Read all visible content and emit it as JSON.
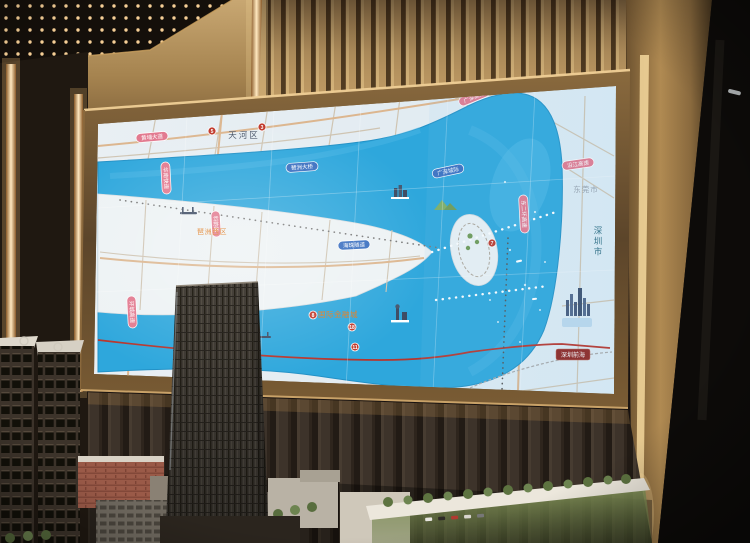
{
  "photo": {
    "screen_map": {
      "district_labels": [
        {
          "id": "tianhe",
          "text": "天河区"
        },
        {
          "id": "pazhou-west",
          "text": "琶洲西区"
        },
        {
          "id": "financial-city",
          "text": "国际金融城"
        },
        {
          "id": "dongguan",
          "text": "东莞市"
        },
        {
          "id": "shenzhen",
          "text": "深圳市"
        },
        {
          "id": "qianhai",
          "text": "深圳前海"
        }
      ],
      "road_labels": [
        {
          "text": "黄埔大道"
        },
        {
          "text": "华南快速"
        },
        {
          "text": "科韵路"
        },
        {
          "text": "广深高速"
        },
        {
          "text": "东二环高速"
        },
        {
          "text": "环城高速"
        },
        {
          "text": "沿江高速"
        }
      ],
      "rail_labels": [
        {
          "text": "琶洲大桥"
        },
        {
          "text": "广深城际"
        },
        {
          "text": "海珠隧道"
        }
      ],
      "metro_badges": [
        "5",
        "3",
        "8",
        "18",
        "11",
        "7"
      ],
      "icons": [
        "bridge-icon",
        "landmark-buildings-icon",
        "hill-icon",
        "tower-landmark-icon",
        "island-trees-icon",
        "city-skyline-icon",
        "boat-icon",
        "metro-badge-icon",
        "helipad-icon"
      ],
      "palette": {
        "water": "#2ea7dc",
        "land": "#e7eef3",
        "orange_label": "#e07b1f",
        "metro_red": "#b8352c",
        "capsule_pink": "#e2798f",
        "capsule_blue": "#3a6fc0",
        "frame_bronze": "#7a5a32",
        "wall_gold": "#b28c58",
        "wainscot_brown": "#332a22",
        "lawn_green": "#7d9157"
      }
    }
  }
}
